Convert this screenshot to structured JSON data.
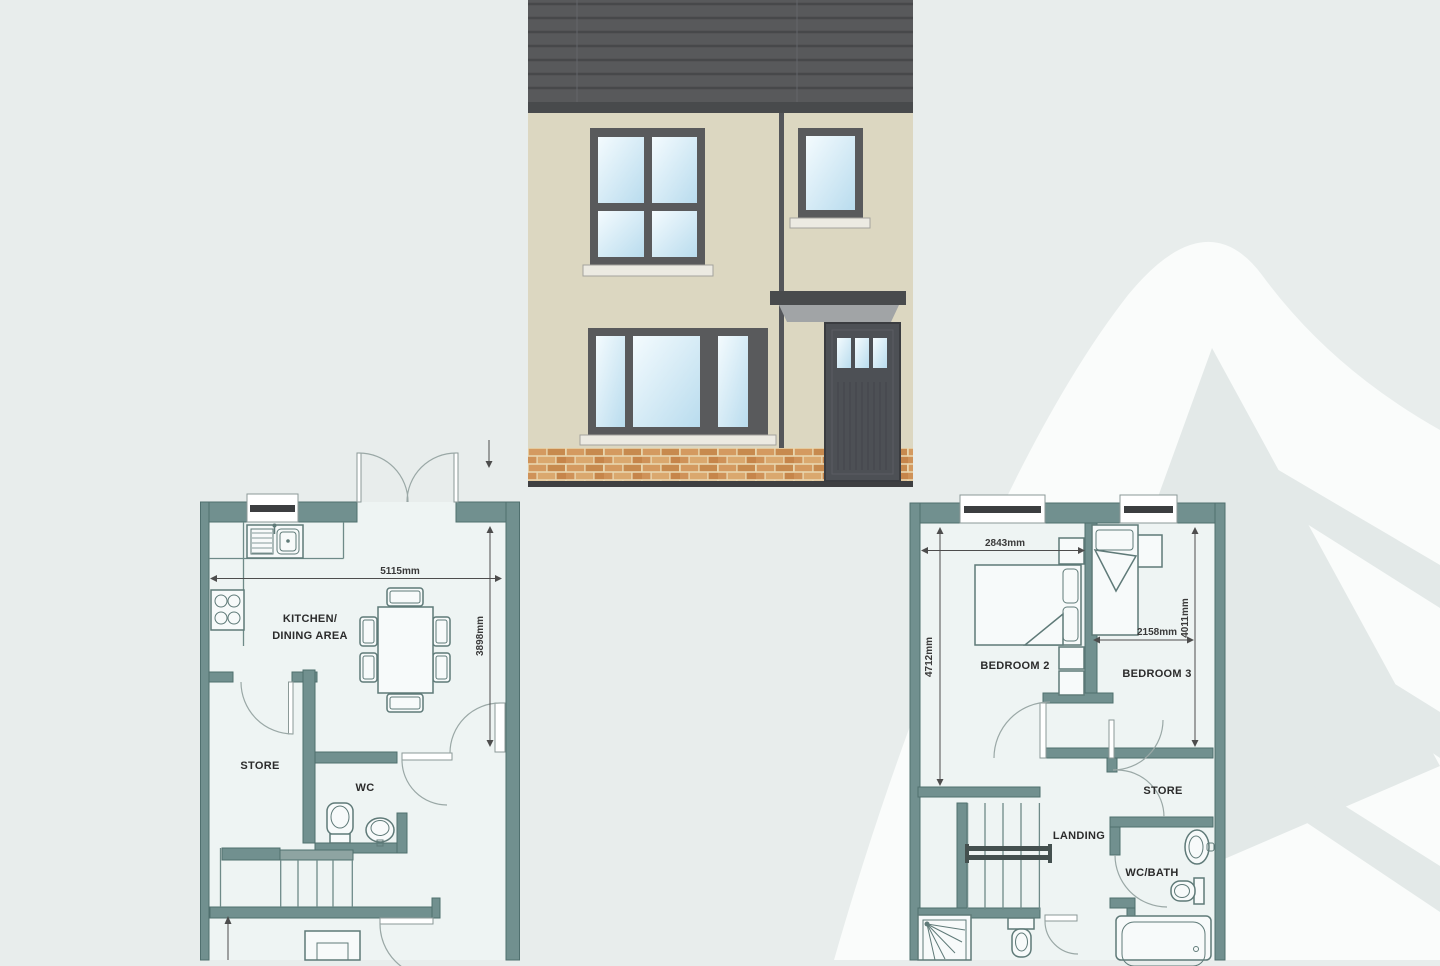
{
  "ground_floor": {
    "labels": {
      "kitchen_line1": "KITCHEN/",
      "kitchen_line2": "DINING AREA",
      "store": "STORE",
      "wc": "WC"
    },
    "dims": {
      "width": "5115mm",
      "depth": "3898mm"
    }
  },
  "first_floor": {
    "labels": {
      "bedroom2": "BEDROOM 2",
      "bedroom3": "BEDROOM 3",
      "store": "STORE",
      "landing": "LANDING",
      "wc_bath": "WC/BATH"
    },
    "dims": {
      "bedroom2_width": "2843mm",
      "bedroom2_depth": "4712mm",
      "bedroom3_width": "2158mm",
      "bedroom3_depth": "4011mm"
    }
  },
  "colors": {
    "background": "#e8edec",
    "plan_wall": "#71908f",
    "plan_room_fill": "#eef4f3",
    "roof": "#58595b",
    "elevation_wall": "#dcd7c1",
    "window_glass": "#cfe7f4",
    "brick": "#d49a60",
    "watermark": "#fafcfb"
  }
}
